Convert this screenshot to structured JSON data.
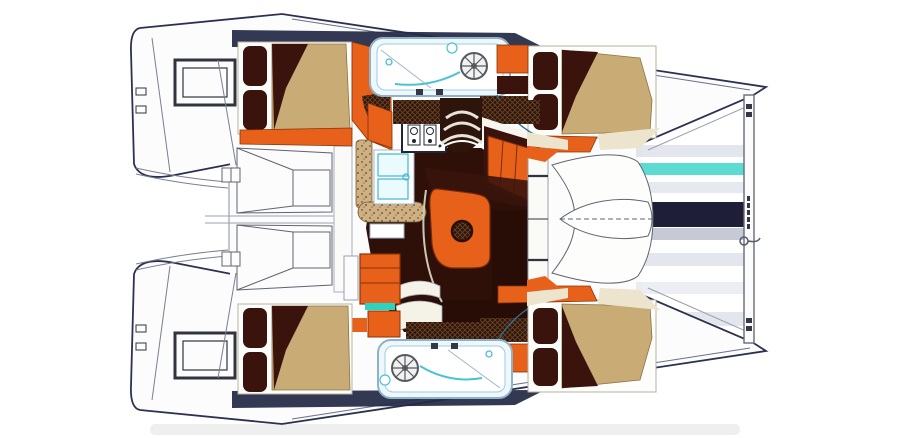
{
  "meta": {
    "title": "Catamaran interior layout floor plan",
    "type": "boat-floor-plan-top-view"
  },
  "palette": {
    "hull_white": "#fcfcfc",
    "outline_navy": "#2c3150",
    "line_gray": "#9aa0b0",
    "frame_gray": "#b8b29e",
    "orange": "#e8611a",
    "orange_stroke": "#8a3408",
    "wood_dark": "#3a140c",
    "wood_darker": "#2b0e07",
    "floor_brown": "#2e1009",
    "bedspread_tan": "#c9ab76",
    "counter_speckle_base": "#cdb084",
    "teal": "#3fc6d6",
    "teal_bright": "#2ad4c0",
    "pale_blue": "#eef8fc",
    "navy_band": "#232946",
    "tramp_gray": "#c9cede",
    "tramp_teal": "#49d7cd",
    "tramp_navy": "#12122e",
    "cream_deck": "#ece4cc",
    "shadow": "#9a9a9a"
  },
  "regions": {
    "boat": "Catamaran deck and interior plan",
    "port_hull": "Port hull",
    "starboard_hull": "Starboard hull",
    "port_aft_cabin": "Port aft cabin double berth",
    "port_head": "Port bathroom with shower",
    "port_fwd_cabin": "Port forward cabin double berth",
    "stbd_aft_cabin": "Starboard aft cabin double berth",
    "stbd_head": "Starboard bathroom with shower",
    "stbd_fwd_cabin": "Starboard forward cabin double berth",
    "saloon": "Saloon with galley and dinette",
    "galley": "Galley with stove and twin sinks",
    "dinette": "Dinette table with settee",
    "cockpit": "Aft cockpit bench seats",
    "swim_platforms": "Twin stern swim platforms",
    "foredeck": "Foredeck locker",
    "trampoline": "Bow trampoline",
    "crossbeam": "Forward crossbeam"
  }
}
